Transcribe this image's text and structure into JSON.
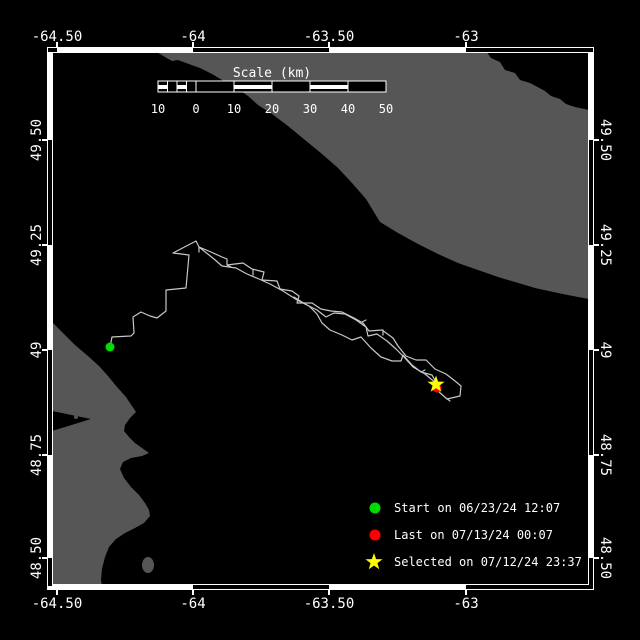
{
  "colors": {
    "background": "#000000",
    "land": "#565656",
    "water": "#000000",
    "frame_white": "#ffffff",
    "frame_black": "#000000",
    "track": "#c8c8c8",
    "text": "#ffffff",
    "start": "#00dc00",
    "last": "#ff0000",
    "selected": "#ffff00"
  },
  "axes": {
    "lon_labels": [
      "-64.50",
      "-64",
      "-63.50",
      "-63"
    ],
    "lat_labels": [
      "49.50",
      "49.25",
      "49",
      "48.75",
      "48.50"
    ]
  },
  "scale_bar": {
    "title": "Scale (km)",
    "tick_labels": [
      "10",
      "0",
      "10",
      "20",
      "30",
      "40",
      "50"
    ]
  },
  "legend": {
    "items": [
      {
        "marker": "circle",
        "color": "#00dc00",
        "label": "Start on 06/23/24 12:07"
      },
      {
        "marker": "circle",
        "color": "#ff0000",
        "label": "Last on 07/13/24 00:07"
      },
      {
        "marker": "star",
        "color": "#ffff00",
        "label": "Selected on 07/12/24 23:37"
      }
    ]
  },
  "markers": {
    "start": {
      "x": 110,
      "y": 347
    },
    "last": {
      "x": 437,
      "y": 388
    },
    "selected": {
      "x": 436,
      "y": 384
    }
  },
  "track": {
    "main": [
      [
        110,
        347
      ],
      [
        112,
        337
      ],
      [
        131,
        336
      ],
      [
        134,
        333
      ],
      [
        133,
        317
      ],
      [
        141,
        312
      ],
      [
        150,
        316
      ],
      [
        157,
        318
      ],
      [
        166,
        311
      ],
      [
        166,
        290
      ],
      [
        186,
        288
      ],
      [
        189,
        255
      ],
      [
        173,
        253
      ],
      [
        196,
        241
      ],
      [
        199,
        247
      ],
      [
        211,
        252
      ],
      [
        222,
        257
      ],
      [
        227,
        259
      ],
      [
        227,
        265
      ],
      [
        243,
        263
      ],
      [
        252,
        269
      ],
      [
        264,
        272
      ],
      [
        262,
        280
      ],
      [
        277,
        281
      ],
      [
        280,
        289
      ],
      [
        292,
        291
      ],
      [
        299,
        296
      ],
      [
        297,
        303
      ],
      [
        312,
        303
      ],
      [
        321,
        309
      ],
      [
        331,
        311
      ],
      [
        342,
        312
      ],
      [
        354,
        318
      ],
      [
        363,
        323
      ],
      [
        369,
        331
      ],
      [
        382,
        330
      ],
      [
        393,
        338
      ],
      [
        398,
        346
      ],
      [
        406,
        356
      ],
      [
        416,
        360
      ],
      [
        426,
        360
      ],
      [
        435,
        369
      ],
      [
        446,
        374
      ],
      [
        455,
        381
      ],
      [
        461,
        386
      ],
      [
        460,
        396
      ],
      [
        447,
        399
      ],
      [
        438,
        391
      ]
    ],
    "loop_lower": [
      [
        199,
        247
      ],
      [
        214,
        259
      ],
      [
        222,
        266
      ],
      [
        236,
        268
      ],
      [
        247,
        274
      ],
      [
        259,
        279
      ],
      [
        270,
        284
      ],
      [
        283,
        291
      ],
      [
        297,
        300
      ],
      [
        309,
        306
      ],
      [
        317,
        314
      ],
      [
        322,
        323
      ],
      [
        330,
        330
      ],
      [
        342,
        335
      ],
      [
        352,
        340
      ],
      [
        361,
        337
      ],
      [
        371,
        348
      ],
      [
        381,
        357
      ],
      [
        392,
        361
      ],
      [
        401,
        361
      ],
      [
        403,
        355
      ],
      [
        412,
        365
      ],
      [
        421,
        372
      ],
      [
        432,
        375
      ],
      [
        437,
        384
      ]
    ],
    "loop_upper": [
      [
        437,
        384
      ],
      [
        425,
        374
      ],
      [
        413,
        367
      ],
      [
        404,
        357
      ],
      [
        396,
        349
      ],
      [
        387,
        341
      ],
      [
        377,
        334
      ],
      [
        368,
        336
      ],
      [
        366,
        327
      ],
      [
        356,
        320
      ],
      [
        345,
        314
      ],
      [
        334,
        313
      ],
      [
        326,
        317
      ],
      [
        317,
        310
      ],
      [
        305,
        304
      ],
      [
        294,
        297
      ]
    ],
    "spurs": [
      [
        [
          199,
          247
        ],
        [
          199,
          252
        ]
      ],
      [
        [
          227,
          265
        ],
        [
          231,
          267
        ]
      ],
      [
        [
          253,
          270
        ],
        [
          253,
          275
        ]
      ],
      [
        [
          362,
          322
        ],
        [
          366,
          320
        ]
      ],
      [
        [
          383,
          330
        ],
        [
          383,
          335
        ]
      ],
      [
        [
          421,
          372
        ],
        [
          425,
          370
        ]
      ],
      [
        [
          446,
          398
        ],
        [
          450,
          401
        ]
      ]
    ]
  }
}
